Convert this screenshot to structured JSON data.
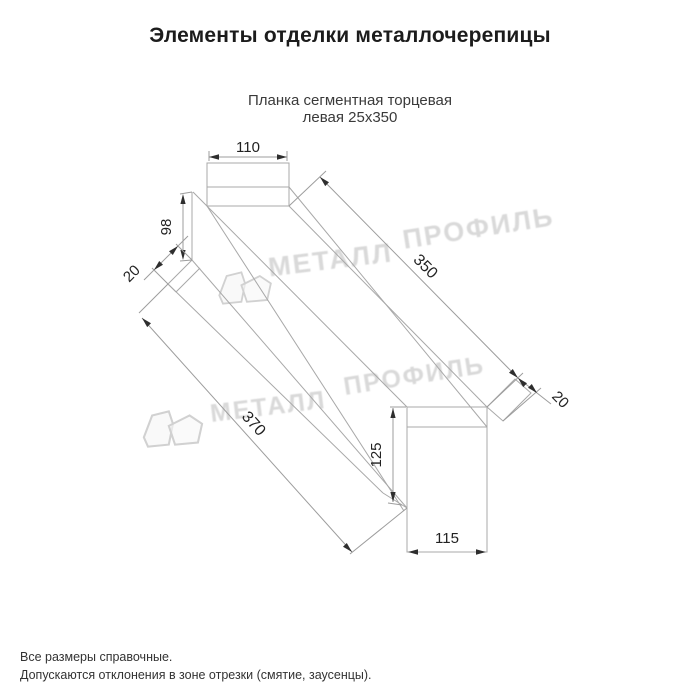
{
  "page": {
    "title": "Элементы отделки металлочерепицы"
  },
  "product": {
    "name_line1": "Планка сегментная торцевая",
    "name_line2": "левая 25x350"
  },
  "dims": {
    "top_width": "110",
    "left_height": "98",
    "left_hem": "20",
    "length_top": "350",
    "length_overall": "370",
    "right_hem": "20",
    "right_height": "125",
    "bottom_width": "115"
  },
  "watermark": {
    "word1": "МЕТАЛЛ",
    "word2": "ПРОФИЛЬ"
  },
  "footer": {
    "line1": "Все размеры справочные.",
    "line2": "Допускаются отклонения в зоне отрезки (смятие, заусенцы)."
  },
  "colors": {
    "line": "#a8a8a8",
    "dimension": "#2e2e2e",
    "watermark": "#c9c9c9",
    "title": "#1c1c1c"
  }
}
